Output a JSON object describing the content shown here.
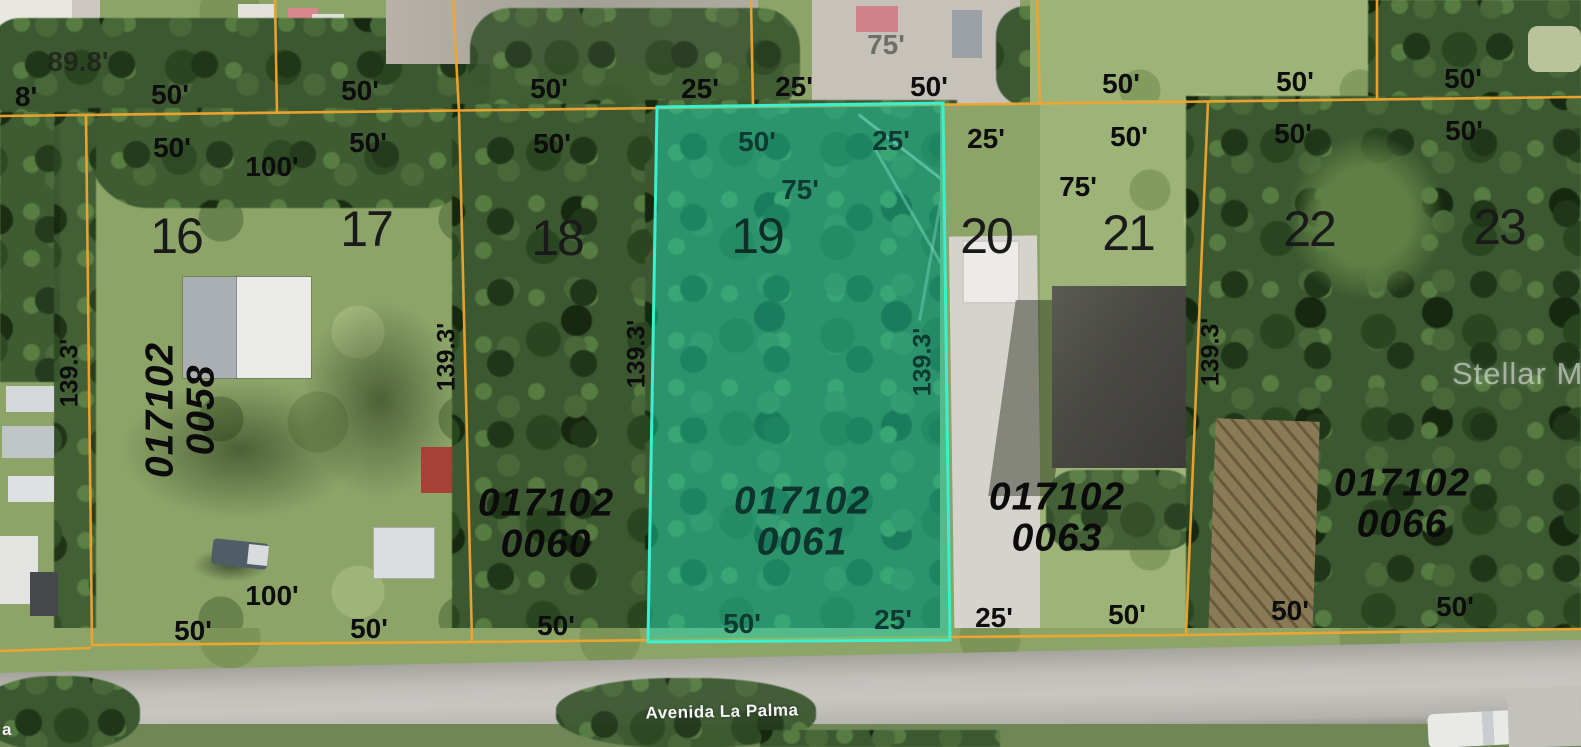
{
  "map": {
    "street": {
      "name": "Avenida La Palma",
      "partial_left_edge": "a"
    },
    "watermark": "Stellar MLS",
    "highlighted_lot": "19",
    "highlighted_parcel_id": "017102 0061",
    "colors": {
      "boundary_line": "#f2a52e",
      "highlight_fill": "#1ecfa9",
      "highlight_border": "#3af0cf"
    },
    "lot_numbers": [
      {
        "text": "16",
        "x": 176,
        "y": 236
      },
      {
        "text": "17",
        "x": 366,
        "y": 229
      },
      {
        "text": "18",
        "x": 557,
        "y": 238
      },
      {
        "text": "19",
        "x": 757,
        "y": 236,
        "variant": "dark"
      },
      {
        "text": "20",
        "x": 986,
        "y": 236
      },
      {
        "text": "21",
        "x": 1128,
        "y": 233
      },
      {
        "text": "22",
        "x": 1309,
        "y": 229
      },
      {
        "text": "23",
        "x": 1499,
        "y": 227
      }
    ],
    "parcel_ids": [
      {
        "line1": "017102",
        "line2": "0058",
        "x": 181,
        "y": 410,
        "rotated": true
      },
      {
        "line1": "017102",
        "line2": "0060",
        "x": 546,
        "y": 524
      },
      {
        "line1": "017102",
        "line2": "0061",
        "x": 802,
        "y": 522,
        "variant": "dark"
      },
      {
        "line1": "017102",
        "line2": "0063",
        "x": 1057,
        "y": 518
      },
      {
        "line1": "017102",
        "line2": "0066",
        "x": 1402,
        "y": 504
      }
    ],
    "dimension_labels": [
      {
        "text": "89.8'",
        "x": 78,
        "y": 62,
        "variant": "shade"
      },
      {
        "text": "8'",
        "x": 26,
        "y": 97
      },
      {
        "text": "50'",
        "x": 170,
        "y": 95
      },
      {
        "text": "50'",
        "x": 360,
        "y": 91
      },
      {
        "text": "50'",
        "x": 549,
        "y": 89
      },
      {
        "text": "25'",
        "x": 700,
        "y": 89
      },
      {
        "text": "25'",
        "x": 794,
        "y": 87
      },
      {
        "text": "75'",
        "x": 886,
        "y": 45,
        "variant": "faint"
      },
      {
        "text": "50'",
        "x": 929,
        "y": 87
      },
      {
        "text": "50'",
        "x": 1121,
        "y": 84
      },
      {
        "text": "50'",
        "x": 1295,
        "y": 82
      },
      {
        "text": "50'",
        "x": 1463,
        "y": 79
      },
      {
        "text": "50'",
        "x": 172,
        "y": 148
      },
      {
        "text": "100'",
        "x": 272,
        "y": 167
      },
      {
        "text": "50'",
        "x": 368,
        "y": 143
      },
      {
        "text": "50'",
        "x": 552,
        "y": 144
      },
      {
        "text": "50'",
        "x": 757,
        "y": 142,
        "variant": "dark"
      },
      {
        "text": "25'",
        "x": 891,
        "y": 141,
        "variant": "dark"
      },
      {
        "text": "25'",
        "x": 986,
        "y": 139
      },
      {
        "text": "50'",
        "x": 1129,
        "y": 137
      },
      {
        "text": "75'",
        "x": 800,
        "y": 190,
        "variant": "dark"
      },
      {
        "text": "75'",
        "x": 1078,
        "y": 187
      },
      {
        "text": "50'",
        "x": 1293,
        "y": 134
      },
      {
        "text": "50'",
        "x": 1464,
        "y": 131
      },
      {
        "text": "100'",
        "x": 272,
        "y": 596
      },
      {
        "text": "50'",
        "x": 193,
        "y": 631
      },
      {
        "text": "50'",
        "x": 369,
        "y": 629
      },
      {
        "text": "50'",
        "x": 556,
        "y": 626
      },
      {
        "text": "50'",
        "x": 742,
        "y": 624,
        "variant": "dark"
      },
      {
        "text": "25'",
        "x": 893,
        "y": 620,
        "variant": "dark"
      },
      {
        "text": "25'",
        "x": 994,
        "y": 618
      },
      {
        "text": "50'",
        "x": 1127,
        "y": 615
      },
      {
        "text": "50'",
        "x": 1290,
        "y": 611
      },
      {
        "text": "50'",
        "x": 1455,
        "y": 607
      }
    ],
    "lot_depth_labels": [
      {
        "text": "139.3'",
        "x": 70,
        "y": 373
      },
      {
        "text": "139.3'",
        "x": 447,
        "y": 357
      },
      {
        "text": "139.3'",
        "x": 637,
        "y": 354
      },
      {
        "text": "139.3'",
        "x": 923,
        "y": 362,
        "variant": "dark"
      },
      {
        "text": "139.3'",
        "x": 1211,
        "y": 352
      }
    ]
  }
}
